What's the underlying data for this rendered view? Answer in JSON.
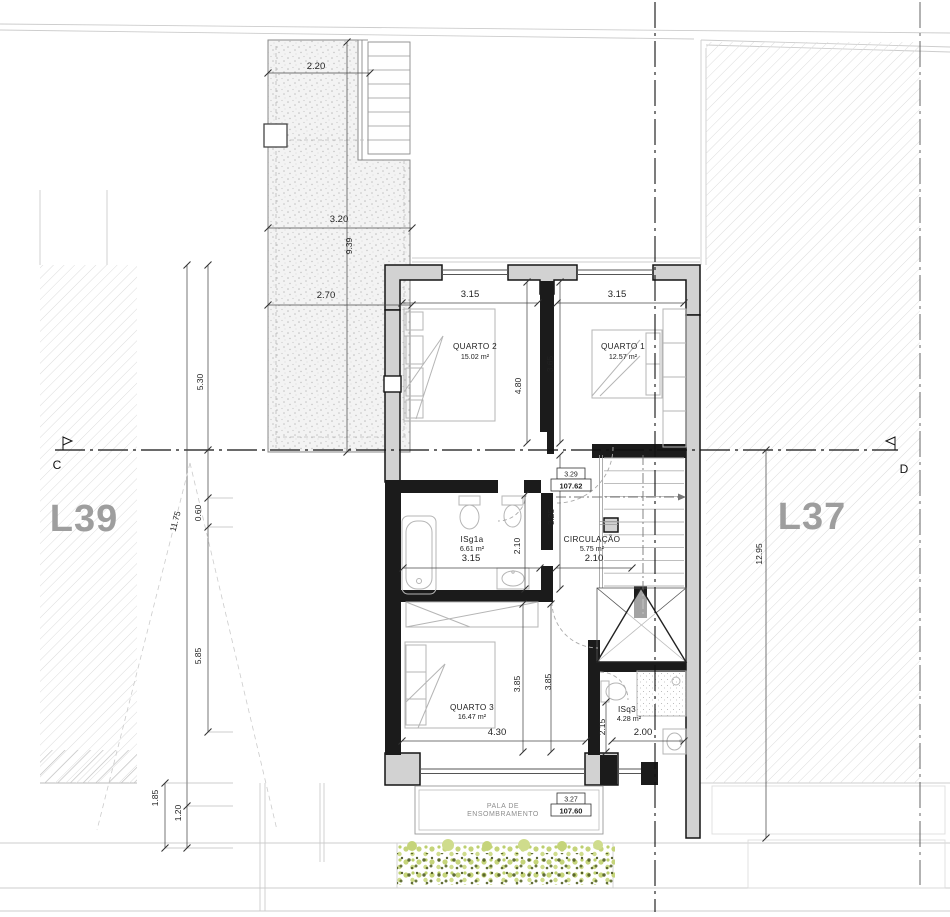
{
  "labels": {
    "lot_left": "L39",
    "lot_right": "L37",
    "section_left": "C",
    "section_right": "D",
    "pala_line1": "PALA DE",
    "pala_line2": "ENSOMBRAMENTO"
  },
  "rooms": {
    "q2": {
      "name": "QUARTO 2",
      "area": "15.02 m²"
    },
    "q1": {
      "name": "QUARTO 1",
      "area": "12.57 m²"
    },
    "isg1a": {
      "name": "ISg1a",
      "area": "6.61 m²"
    },
    "circ": {
      "name": "CIRCULAÇÃO",
      "area": "5.75 m²"
    },
    "q3": {
      "name": "QUARTO 3",
      "area": "16.47 m²"
    },
    "isq3": {
      "name": "ISq3",
      "area": "4.28 m²"
    }
  },
  "levels": {
    "upper": {
      "height": "3.29",
      "elevation": "107.62"
    },
    "lower": {
      "height": "3.27",
      "elevation": "107.60"
    }
  },
  "dims": {
    "d220": "2.20",
    "d320": "3.20",
    "d939": "9.39",
    "d270": "2.70",
    "d530": "5.30",
    "d1175": "11.75",
    "d060": "0.60",
    "d585": "5.85",
    "d185": "1.85",
    "d120": "1.20",
    "d1295": "12.95",
    "q2w": "3.15",
    "q2h": "4.80",
    "q1w": "3.15",
    "q1h": "3.65",
    "bathw": "3.15",
    "bathh": "2.10",
    "d325": "3.25",
    "circw": "2.10",
    "q3w": "4.30",
    "q3h1": "3.85",
    "q3h2": "3.85",
    "isq3h": "2.15",
    "isq3w": "2.00"
  },
  "colors": {
    "wall_fill": "#d2d2d2",
    "interior_wall": "#1b1b1b",
    "veg_light": "#c5d47a",
    "veg_dark": "#4f5c22",
    "lot_text": "#9e9e9e"
  }
}
